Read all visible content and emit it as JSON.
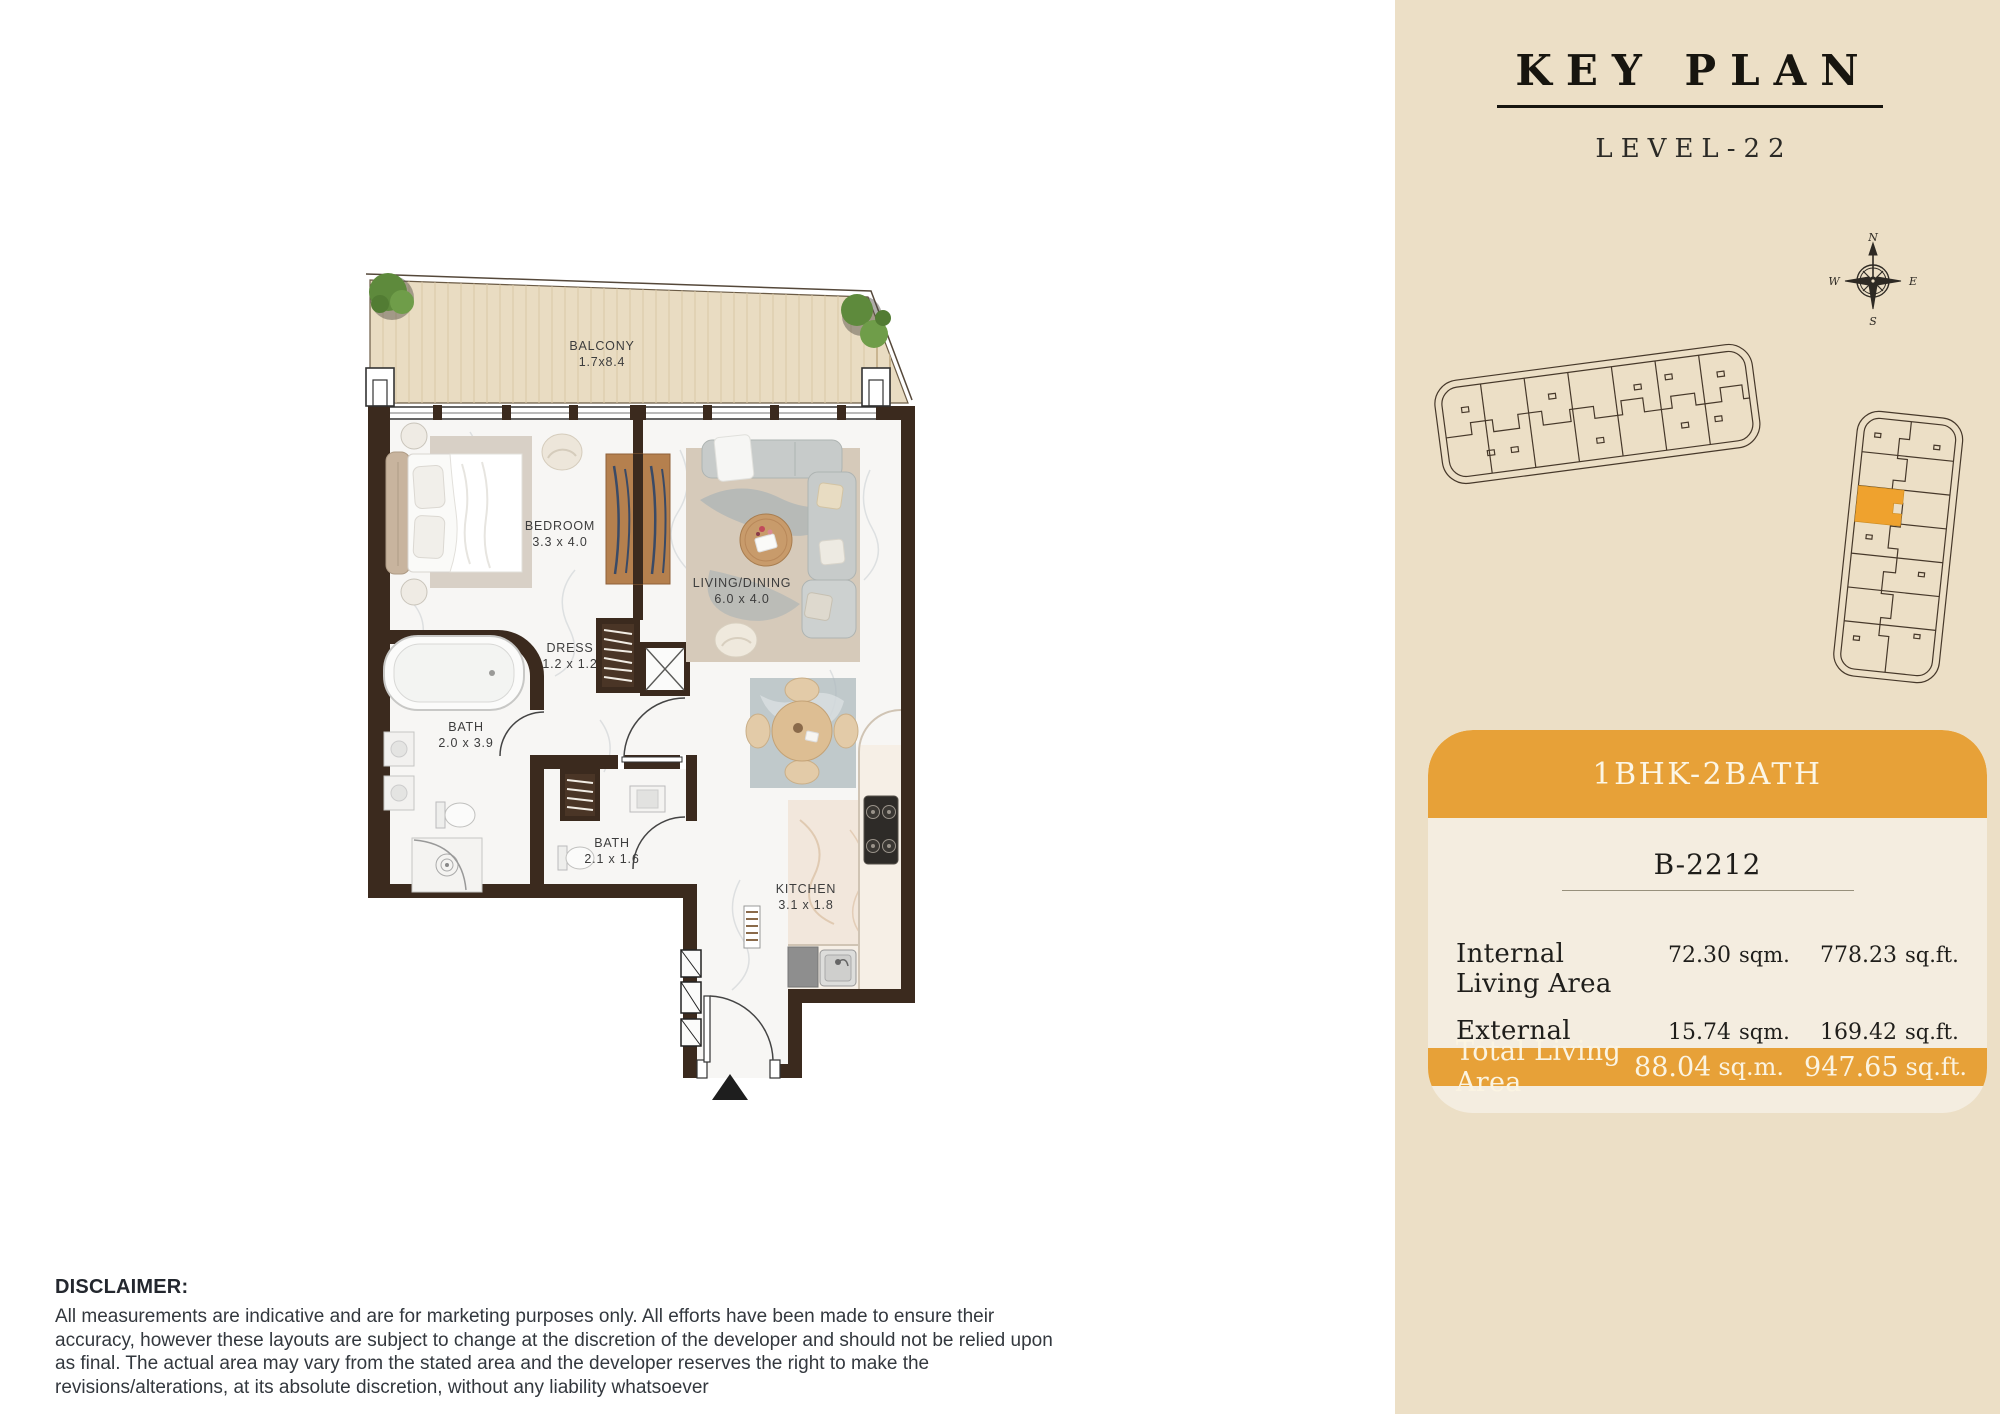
{
  "key_plan": {
    "title": "KEY PLAN",
    "level": "LEVEL-22",
    "compass": {
      "north": "N",
      "east": "E",
      "south": "S",
      "west": "W"
    }
  },
  "unit_card": {
    "type_label": "1BHK-2BATH",
    "unit_number": "B-2212",
    "rows": [
      {
        "label": "Internal Living Area",
        "sqm_value": "72.30",
        "sqm_unit": "sqm.",
        "sqft_value": "778.23",
        "sqft_unit": "sq.ft."
      },
      {
        "label": "External Living Area",
        "sqm_value": "15.74",
        "sqm_unit": "sqm.",
        "sqft_value": "169.42",
        "sqft_unit": "sq.ft."
      }
    ],
    "total": {
      "label": "Total Living Area",
      "sqm_value": "88.04",
      "sqm_unit": "sq.m.",
      "sqft_value": "947.65",
      "sqft_unit": "sq.ft."
    }
  },
  "floor_plan": {
    "rooms": [
      {
        "name": "BALCONY",
        "dims": "1.7x8.4"
      },
      {
        "name": "BEDROOM",
        "dims": "3.3 x 4.0"
      },
      {
        "name": "LIVING/DINING",
        "dims": "6.0 x 4.0"
      },
      {
        "name": "DRESS",
        "dims": "1.2 x 1.2"
      },
      {
        "name": "BATH",
        "dims": "2.0 x 3.9"
      },
      {
        "name": "BATH",
        "dims": "2.1 x 1.6"
      },
      {
        "name": "KITCHEN",
        "dims": "3.1 x 1.8"
      }
    ]
  },
  "disclaimer": {
    "heading": "DISCLAIMER:",
    "body": "All measurements are indicative and are for marketing purposes only. All efforts have been made to ensure their accuracy, however these layouts are subject to change at the discretion of the developer and should not be relied upon as final. The actual area may vary from the stated area and the developer reserves the right to make the revisions/alterations, at its absolute discretion, without any liability whatsoever"
  },
  "colors": {
    "accent_orange": "#E7A138",
    "highlighted_unit_orange": "#EFA22E",
    "sidebar_bg": "#ECDFC6",
    "card_bg": "#F4EDE0",
    "wall_brown": "#3B2A1E",
    "balcony_deck": "#E9DCC2"
  }
}
